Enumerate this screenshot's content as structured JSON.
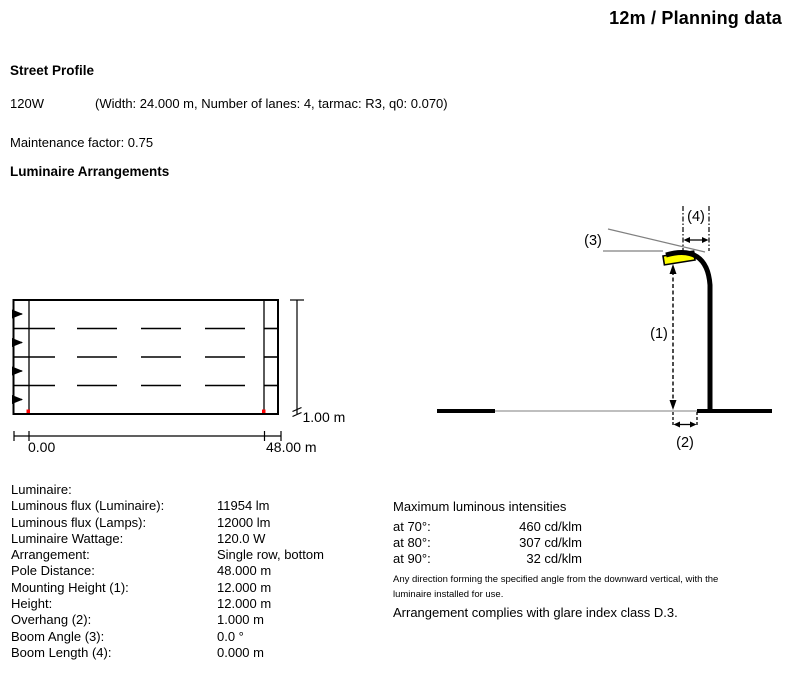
{
  "header": {
    "title": "12m / Planning data"
  },
  "street_profile": {
    "heading": "Street Profile",
    "wattage": "120W",
    "params": "(Width: 24.000 m, Number of lanes: 4, tarmac: R3, q0: 0.070)",
    "maintenance_factor": "Maintenance factor: 0.75"
  },
  "luminaire_arrangements": {
    "heading": "Luminaire Arrangements"
  },
  "street_diagram": {
    "start_label": "0.00",
    "end_label": "48.00 m",
    "offset_label": "1.00 m",
    "lanes": 4,
    "direction": "left-to-right"
  },
  "pole_diagram": {
    "mounting_height_label": "(1)",
    "overhang_label": "(2)",
    "boom_angle_label": "(3)",
    "boom_length_label": "(4)"
  },
  "luminaire_table": {
    "rows": [
      {
        "label": "Luminaire:",
        "value": ""
      },
      {
        "label": "Luminous flux (Luminaire):",
        "value": "11954 lm"
      },
      {
        "label": "Luminous flux (Lamps):",
        "value": "12000 lm"
      },
      {
        "label": "Luminaire Wattage:",
        "value": "120.0 W"
      },
      {
        "label": "Arrangement:",
        "value": "Single row, bottom"
      },
      {
        "label": "Pole Distance:",
        "value": "48.000 m"
      },
      {
        "label": "Mounting Height (1):",
        "value": "12.000 m"
      },
      {
        "label": "Height:",
        "value": "12.000 m"
      },
      {
        "label": "Overhang (2):",
        "value": "1.000 m"
      },
      {
        "label": "Boom Angle (3):",
        "value": "0.0 °"
      },
      {
        "label": "Boom Length (4):",
        "value": "0.000 m"
      }
    ]
  },
  "intensities": {
    "heading": "Maximum luminous intensities",
    "rows": [
      {
        "label": "at 70°:",
        "value": "460 cd/klm"
      },
      {
        "label": "at 80°:",
        "value": "307 cd/klm"
      },
      {
        "label": "at 90°:",
        "value": "32 cd/klm"
      }
    ],
    "note_line1": "Any direction forming the specified angle from the downward vertical, with the",
    "note_line2": "luminaire installed for use.",
    "glare_note": "Arrangement complies with glare index class D.3."
  },
  "colors": {
    "luminaire_fill": "#ffff00",
    "marker_red": "#ff0000",
    "ground_gray": "#999999",
    "leader_gray": "#808080"
  }
}
